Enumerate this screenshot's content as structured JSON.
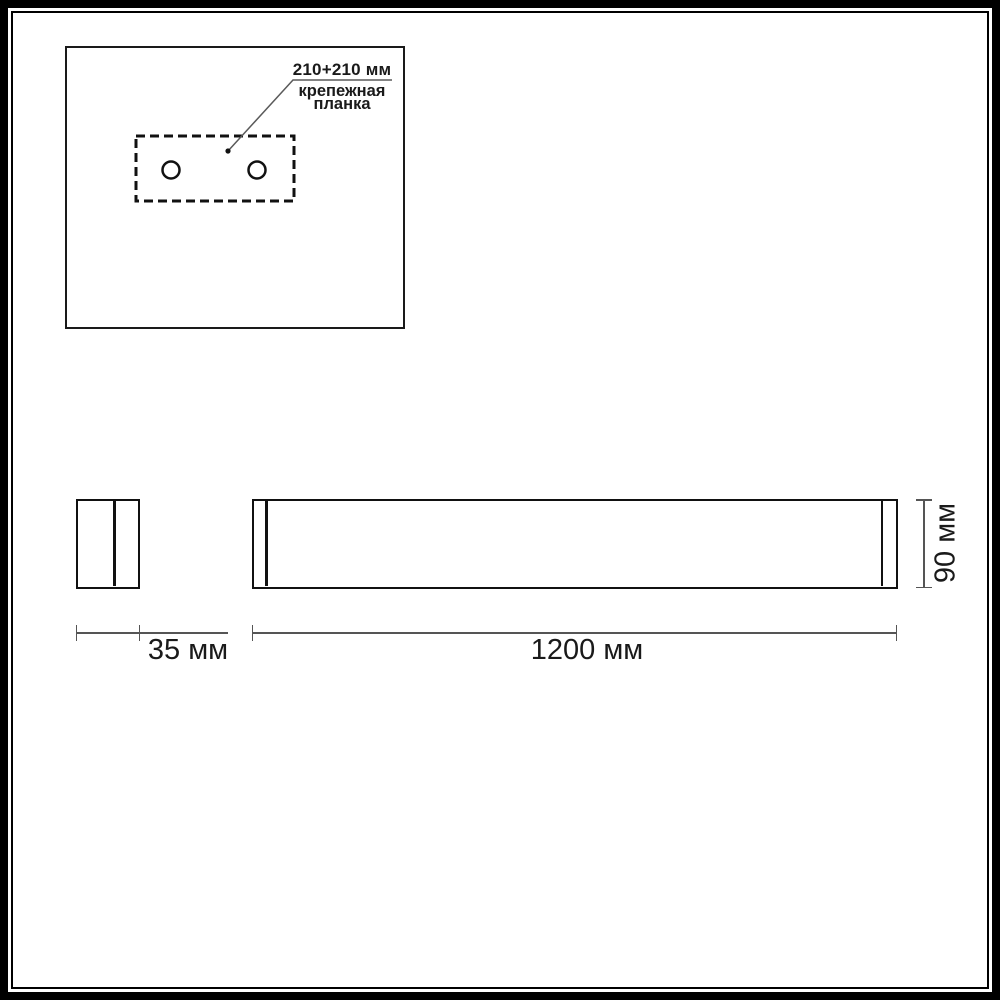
{
  "drawing": {
    "kind": "technical-dimension-drawing",
    "subject": "linear wall luminaire with mounting plate"
  },
  "plan_view": {
    "leader_label": "210+210 мм",
    "caption_line1": "крепежная",
    "caption_line2": "планка",
    "hole_count": 2
  },
  "dimensions": {
    "depth_label": "35 мм",
    "length_label": "1200 мм",
    "height_label": "90 мм"
  },
  "colors": {
    "outline": "#111111",
    "frame": "#000000",
    "dimension_line": "#555555",
    "text": "#1a1a1a",
    "background": "#ffffff"
  }
}
